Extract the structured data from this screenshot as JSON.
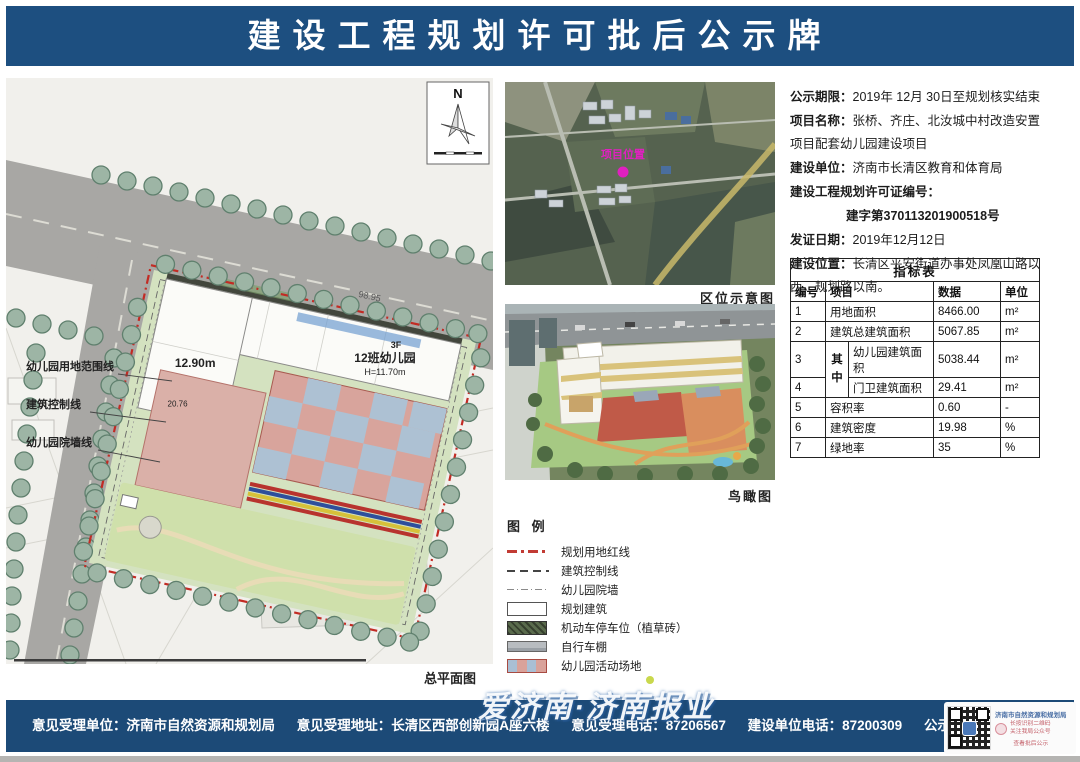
{
  "header": {
    "title": "建设工程规划许可批后公示牌"
  },
  "site_plan": {
    "caption": "总平面图",
    "north_label": "N",
    "callouts": [
      "幼儿园用地范围线",
      "建筑控制线",
      "幼儿园院墙线"
    ],
    "building": {
      "height_left": "12.90m",
      "dim_left": "20.76",
      "top_dim": "98.95",
      "floors": "3F",
      "name": "12班幼儿园",
      "height": "H=11.70m"
    }
  },
  "location_map": {
    "caption": "区位示意图",
    "marker_label": "项目位置"
  },
  "bird_view": {
    "caption": "鸟瞰图"
  },
  "legend": {
    "title": "图 例",
    "items": [
      {
        "label": "规划用地红线"
      },
      {
        "label": "建筑控制线"
      },
      {
        "label": "幼儿园院墙"
      },
      {
        "label": "规划建筑"
      },
      {
        "label": "机动车停车位（植草砖）"
      },
      {
        "label": "自行车棚"
      },
      {
        "label": "幼儿园活动场地"
      }
    ]
  },
  "info": {
    "lines": [
      {
        "label": "公示期限：",
        "text": "2019年 12月 30日至规划核实结束"
      },
      {
        "label": "项目名称：",
        "text": "张桥、齐庄、北汝城中村改造安置项目配套幼儿园建设项目"
      },
      {
        "label": "建设单位：",
        "text": "济南市长清区教育和体育局"
      },
      {
        "label": "建设工程规划许可证编号：",
        "text": ""
      },
      {
        "label": "",
        "text": "建字第370113201900518号"
      },
      {
        "label": "发证日期：",
        "text": "2019年12月12日"
      },
      {
        "label": "建设位置：",
        "text": "长清区平安街道办事处凤凰山路以西，规划路以南。"
      }
    ]
  },
  "table": {
    "title": "指标表",
    "headers": [
      "编号",
      "项目",
      "数据",
      "单位"
    ],
    "merge_label": "其中",
    "rows": [
      {
        "no": "1",
        "item": "用地面积",
        "value": "8466.00",
        "unit": "m²"
      },
      {
        "no": "2",
        "item": "建筑总建筑面积",
        "value": "5067.85",
        "unit": "m²"
      },
      {
        "no": "3",
        "item": "幼儿园建筑面积",
        "value": "5038.44",
        "unit": "m²"
      },
      {
        "no": "4",
        "item": "门卫建筑面积",
        "value": "29.41",
        "unit": "m²"
      },
      {
        "no": "5",
        "item": "容积率",
        "value": "0.60",
        "unit": "-"
      },
      {
        "no": "6",
        "item": "建筑密度",
        "value": "19.98",
        "unit": "%"
      },
      {
        "no": "7",
        "item": "绿地率",
        "value": "35",
        "unit": "%"
      }
    ]
  },
  "footer": {
    "items": [
      {
        "label": "意见受理单位：",
        "value": "济南市自然资源和规划局"
      },
      {
        "label": "意见受理地址：",
        "value": "长清区西部创新园A座六楼"
      },
      {
        "label": "意见受理电话：",
        "value": "87206567"
      },
      {
        "label": "建设单位电话：",
        "value": "87200309"
      },
      {
        "label": "公示查询地址：",
        "value": "http://nrp.jinan.gov.cn"
      }
    ],
    "watermark": "爱济南·济南报业",
    "qr_card": {
      "org": "济南市自然资源和规划局",
      "note1": "长按识别二维码",
      "note2": "关注我局公众号",
      "note3": "查看批后公示"
    }
  },
  "colors": {
    "header_blue": "#1d4f80",
    "footer_blue": "#1c4a77",
    "red_line": "#c22b24",
    "marker_magenta": "#e020c0"
  }
}
